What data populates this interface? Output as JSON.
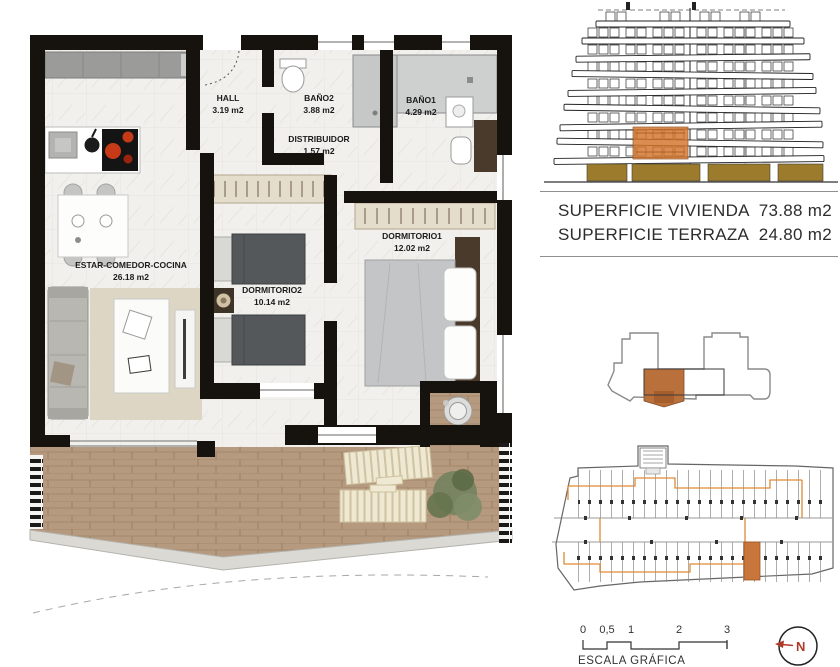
{
  "document": {
    "type": "apartment floor plan sheet"
  },
  "floor_plan": {
    "rooms": [
      {
        "id": "hall",
        "name": "HALL",
        "area": "3.19 m2"
      },
      {
        "id": "bano2",
        "name": "BAÑO2",
        "area": "3.88 m2"
      },
      {
        "id": "bano1",
        "name": "BAÑO1",
        "area": "4.29 m2"
      },
      {
        "id": "distribuidor",
        "name": "DISTRIBUIDOR",
        "area": "1.57 m2"
      },
      {
        "id": "estar",
        "name": "ESTAR-COMEDOR-COCINA",
        "area": "26.18 m2"
      },
      {
        "id": "dorm2",
        "name": "DORMITORIO2",
        "area": "10.14 m2"
      },
      {
        "id": "dorm1",
        "name": "DORMITORIO1",
        "area": "12.02 m2"
      }
    ]
  },
  "summary": {
    "rows": [
      {
        "label": "SUPERFICIE VIVIENDA",
        "value": "73.88 m2"
      },
      {
        "label": "SUPERFICIE TERRAZA",
        "value": "24.80 m2"
      }
    ]
  },
  "scale_bar": {
    "ticks": [
      "0",
      "0,5",
      "1",
      "2",
      "3"
    ],
    "caption": "ESCALA GRÁFICA"
  },
  "compass": {
    "label": "N"
  },
  "colors": {
    "highlight_orange": "#c9742e",
    "wood": "#b59a7f",
    "wall_black": "#16130f",
    "base_tan": "#9d7b2d"
  }
}
